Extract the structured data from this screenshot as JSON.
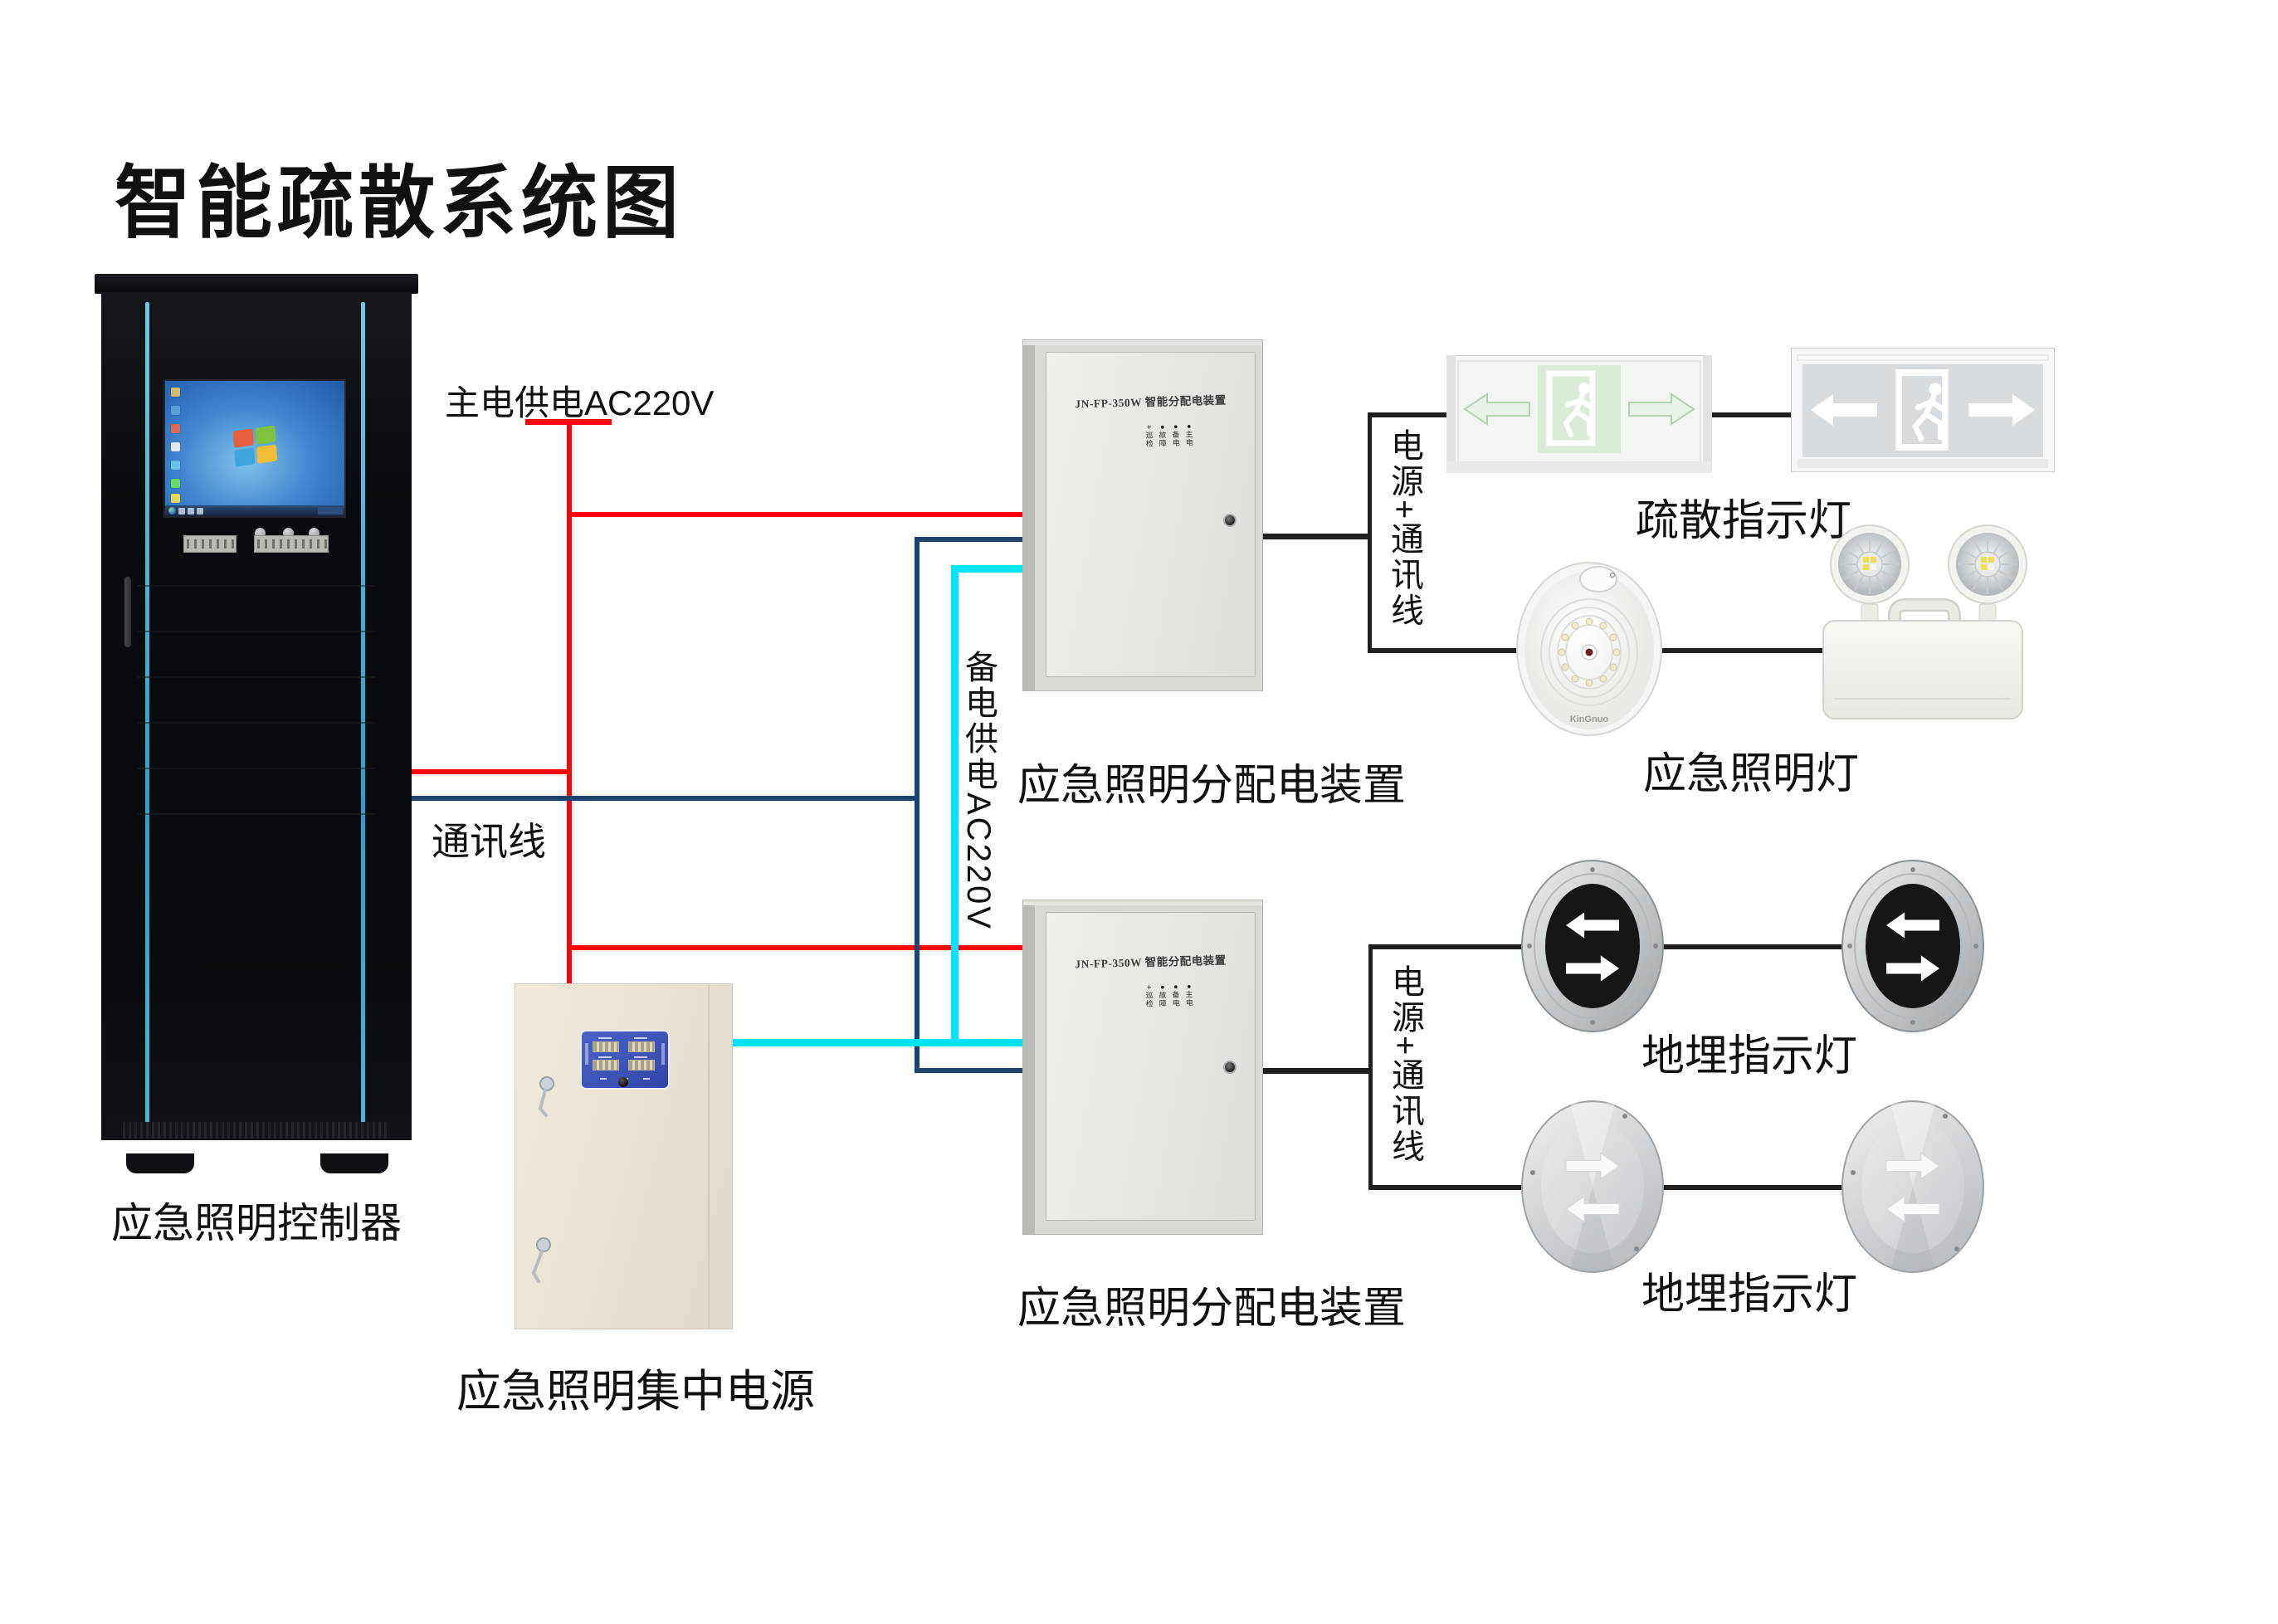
{
  "title": "智能疏散系统图",
  "colors": {
    "wire_main": "#fb0204",
    "wire_comm": "#1b4270",
    "wire_backup": "#00e4fb",
    "wire_connector": "#1f1f1f",
    "rack_accent": "#3fc3ec",
    "psu_panel_blue": "#3e53b5",
    "sign_green": "#cfe3cf",
    "text": "#000000"
  },
  "labels": {
    "main_power": "主电供电AC220V",
    "comm": "通讯线",
    "backup_power": "备电供电AC220V",
    "power_comm": "电源+通讯线",
    "controller": "应急照明控制器",
    "psu": "应急照明集中电源",
    "dist_box": "应急照明分配电装置",
    "exit_sign": "疏散指示灯",
    "emergency_light": "应急照明灯",
    "ground_light": "地埋指示灯"
  },
  "distribution_box": {
    "door_title": "JN-FP-350W 智能分配电装置",
    "indicators": [
      {
        "symbol": "+",
        "line1": "巡",
        "line2": "检"
      },
      {
        "symbol": "●",
        "line1": "故",
        "line2": "障"
      },
      {
        "symbol": "●",
        "line1": "备",
        "line2": "电"
      },
      {
        "symbol": "●",
        "line1": "主",
        "line2": "电"
      }
    ]
  },
  "devices": {
    "round_light_brand": "KinGnuo"
  }
}
